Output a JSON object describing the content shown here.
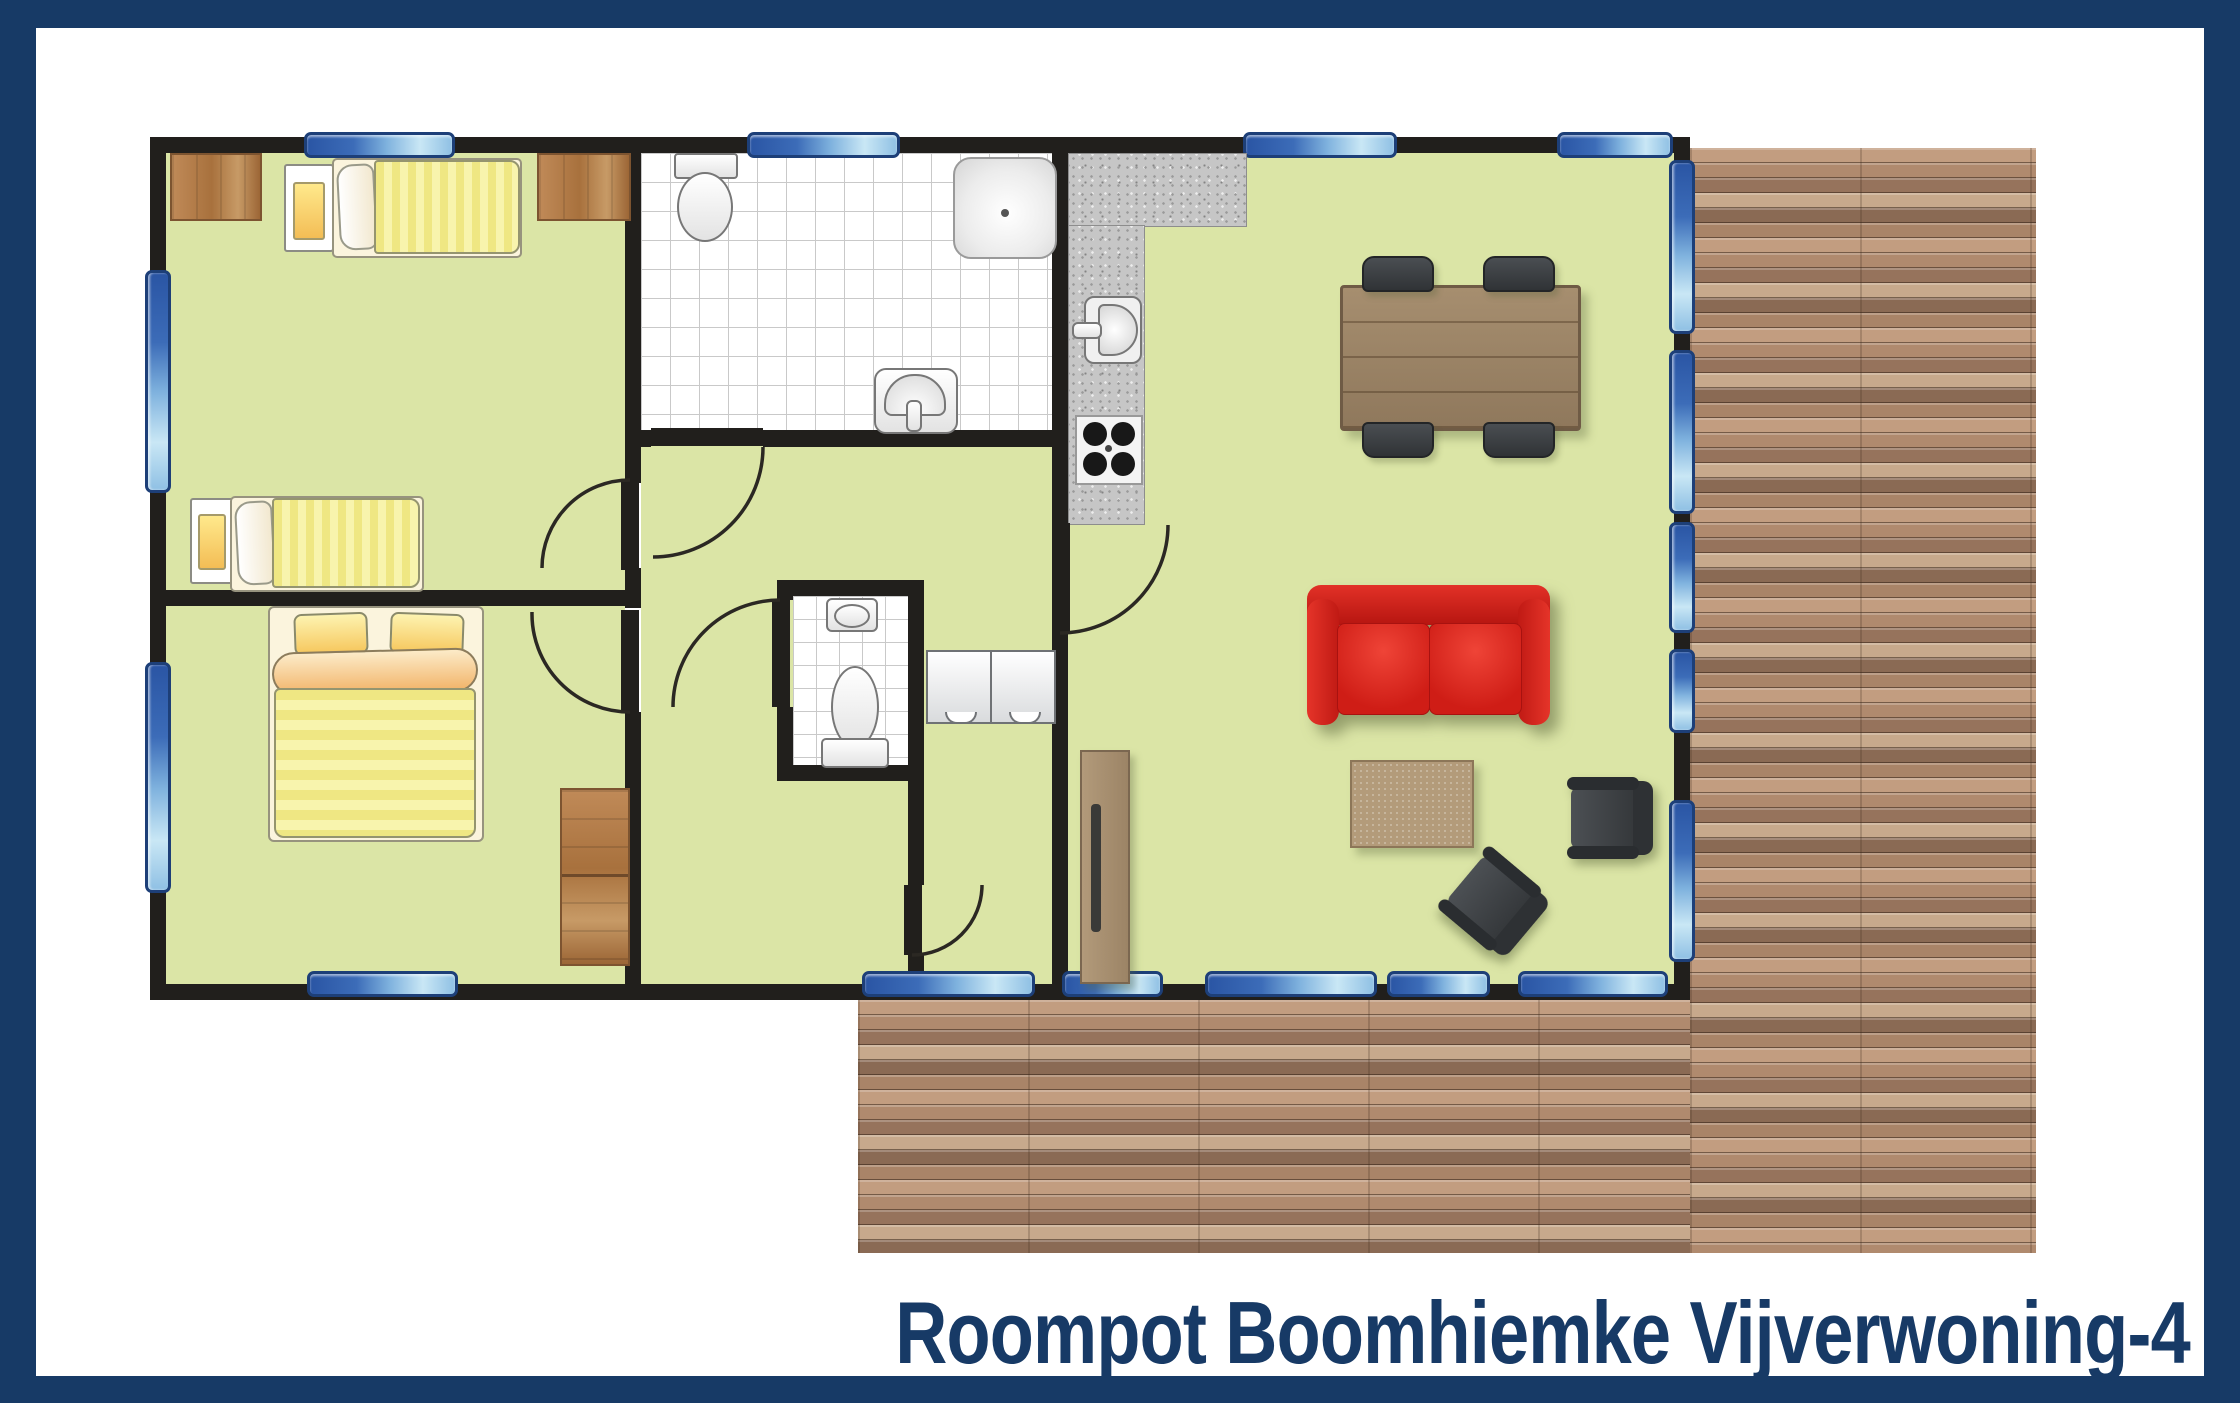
{
  "title": {
    "text": "Roompot Boomhiemke Vijverwoning-4"
  },
  "colors": {
    "frame_navy": "#173a66",
    "floor_green": "#dbe5a6",
    "wall_black": "#211f1c",
    "window_blue_dark": "#2a55a4",
    "window_blue_light": "#c9e7f5",
    "deck_brown": "#a8836a",
    "sofa_red": "#d8231f",
    "furniture_wood": "#9b8265",
    "counter_granite": "#c6c6c6",
    "bed_yellow": "#efe783",
    "closet_brown": "#b5825a",
    "tile_white": "#ffffff"
  },
  "plan": {
    "rooms": [
      {
        "name": "bedroom-top-left",
        "furniture": [
          "single-bed",
          "single-bed",
          "nightstand",
          "nightstand",
          "corner-closet",
          "corner-closet"
        ]
      },
      {
        "name": "bedroom-bottom-left",
        "furniture": [
          "double-bed",
          "wardrobe"
        ]
      },
      {
        "name": "bathroom",
        "furniture": [
          "toilet",
          "shower",
          "washbasin"
        ]
      },
      {
        "name": "hallway",
        "furniture": []
      },
      {
        "name": "wc",
        "furniture": [
          "toilet",
          "washbasin"
        ]
      },
      {
        "name": "storage",
        "furniture": [
          "cabinet",
          "cabinet"
        ]
      },
      {
        "name": "living-room",
        "furniture": [
          "kitchen-counter",
          "kitchen-sink",
          "stove",
          "dining-table",
          "chair",
          "chair",
          "chair",
          "chair",
          "sofa",
          "coffee-table",
          "armchair",
          "armchair",
          "sideboard"
        ]
      },
      {
        "name": "terrace-right",
        "furniture": []
      },
      {
        "name": "terrace-bottom",
        "furniture": []
      }
    ],
    "window_count": 15,
    "door_count": 6
  }
}
